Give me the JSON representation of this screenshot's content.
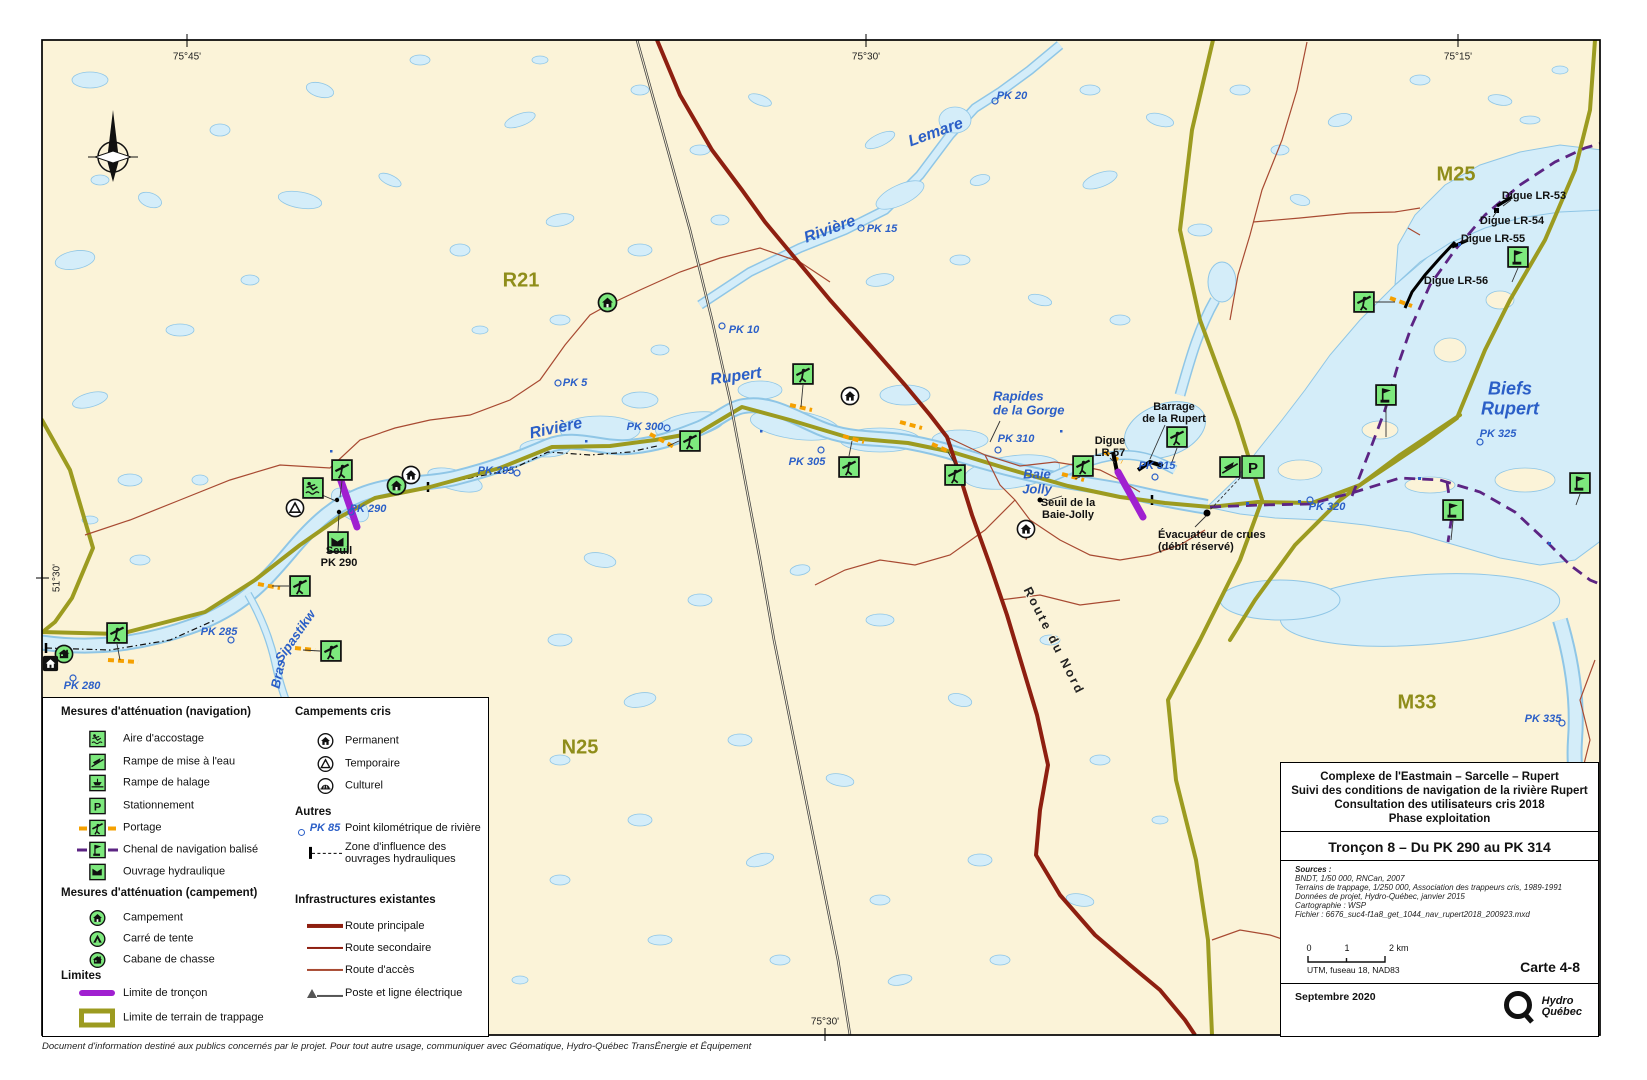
{
  "map": {
    "graticule": {
      "top_left": "75°45'",
      "top_center": "75°30'",
      "top_right": "75°15'",
      "bottom_center": "75°30'",
      "left": "51°30'"
    },
    "labels": {
      "pk5": "PK 5",
      "pk10": "PK 10",
      "pk15": "PK 15",
      "pk20": "PK 20",
      "pk280": "PK 280",
      "pk285": "PK 285",
      "pk290": "PK 290",
      "pk295": "PK 295",
      "pk300": "PK 300",
      "pk305": "PK 305",
      "pk310": "PK 310",
      "pk315": "PK 315",
      "pk320": "PK 320",
      "pk325": "PK 325",
      "pk335": "PK 335",
      "riviere_w": "Rivière",
      "rupert": "Rupert",
      "riviere_ne": "Rivière",
      "lemare": "Lemare",
      "sipastikw": "Sipastikw",
      "bras": "Bras",
      "rapides_1": "Rapides",
      "rapides_2": "de la Gorge",
      "baie_1": "Baie",
      "baie_2": "Jolly",
      "biefs_1": "Biefs",
      "biefs_2": "Rupert",
      "r21": "R21",
      "m25": "M25",
      "m33": "M33",
      "n25": "N25",
      "digue53": "Digue LR-53",
      "digue54": "Digue LR-54",
      "digue55": "Digue LR-55",
      "digue56": "Digue LR-56",
      "digue57_1": "Digue",
      "digue57_2": "LR-57",
      "barrage_1": "Barrage",
      "barrage_2": "de la Rupert",
      "seuil_bj_1": "Seuil de la",
      "seuil_bj_2": "Baie-Jolly",
      "seuil290_1": "Seuil",
      "seuil290_2": "PK 290",
      "evac_1": "Évacuateur de crues",
      "evac_2": "(débit réservé)",
      "route_du_nord": "Route du Nord"
    }
  },
  "icons": {
    "parking_glyph": "P"
  },
  "legend": {
    "nav_title": "Mesures d'atténuation (navigation)",
    "accostage": "Aire d'accostage",
    "rampe_eau": "Rampe de mise à l'eau",
    "rampe_halage": "Rampe de halage",
    "stationnement": "Stationnement",
    "portage": "Portage",
    "chenal": "Chenal de navigation balisé",
    "ouvrage": "Ouvrage hydraulique",
    "camp_title": "Mesures d'atténuation (campement)",
    "campement": "Campement",
    "carre": "Carré de tente",
    "cabane": "Cabane de chasse",
    "limites_title": "Limites",
    "limite_troncon": "Limite de tronçon",
    "limite_trappage": "Limite de terrain de trappage",
    "cris_title": "Campements cris",
    "permanent": "Permanent",
    "temporaire": "Temporaire",
    "culturel": "Culturel",
    "autres_title": "Autres",
    "pk85": "PK 85",
    "point_km": "Point kilométrique de rivière",
    "zone_1": "Zone d'influence des",
    "zone_2": "ouvrages hydrauliques",
    "infra_title": "Infrastructures existantes",
    "route_principale": "Route principale",
    "route_secondaire": "Route secondaire",
    "route_acces": "Route d'accès",
    "poste_ligne": "Poste et ligne électrique"
  },
  "title_block": {
    "line1": "Complexe de l'Eastmain – Sarcelle – Rupert",
    "line2": "Suivi des conditions de navigation de la rivière Rupert",
    "line3": "Consultation des utilisateurs cris 2018",
    "line4": "Phase exploitation",
    "troncon": "Tronçon 8 – Du PK 290 au PK 314",
    "sources_label": "Sources :",
    "source1": "BNDT, 1/50 000, RNCan, 2007",
    "source2": "Terrains de trappage, 1/250 000, Association des trappeurs cris, 1989-1991",
    "source3": "Données de projet, Hydro-Québec, janvier 2015",
    "source4": "Cartographie : WSP",
    "source5": "Fichier : 6676_suc4-f1a8_get_1044_nav_rupert2018_200923.mxd",
    "scale0": "0",
    "scale1": "1",
    "scale2": "2 km",
    "datum": "UTM, fuseau 18, NAD83",
    "carte": "Carte 4-8",
    "date": "Septembre 2020",
    "logo1": "Hydro",
    "logo2": "Québec"
  },
  "footer": "Document d'information destiné aux publics concernés par le projet. Pour tout autre usage, communiquer avec Géomatique, Hydro-Québec TransÉnergie et Équipement",
  "colors": {
    "land": "#FBF3D8",
    "water": "#D4EDF9",
    "water_line": "#8FC6E6",
    "trapline": "#9C9B20",
    "route_principale": "#8E1F10",
    "chenal": "#5C2483",
    "limite_troncon": "#A020D0",
    "portage": "#F5A000",
    "label_blue": "#2B5FC7",
    "label_olive": "#8F8D1A"
  }
}
